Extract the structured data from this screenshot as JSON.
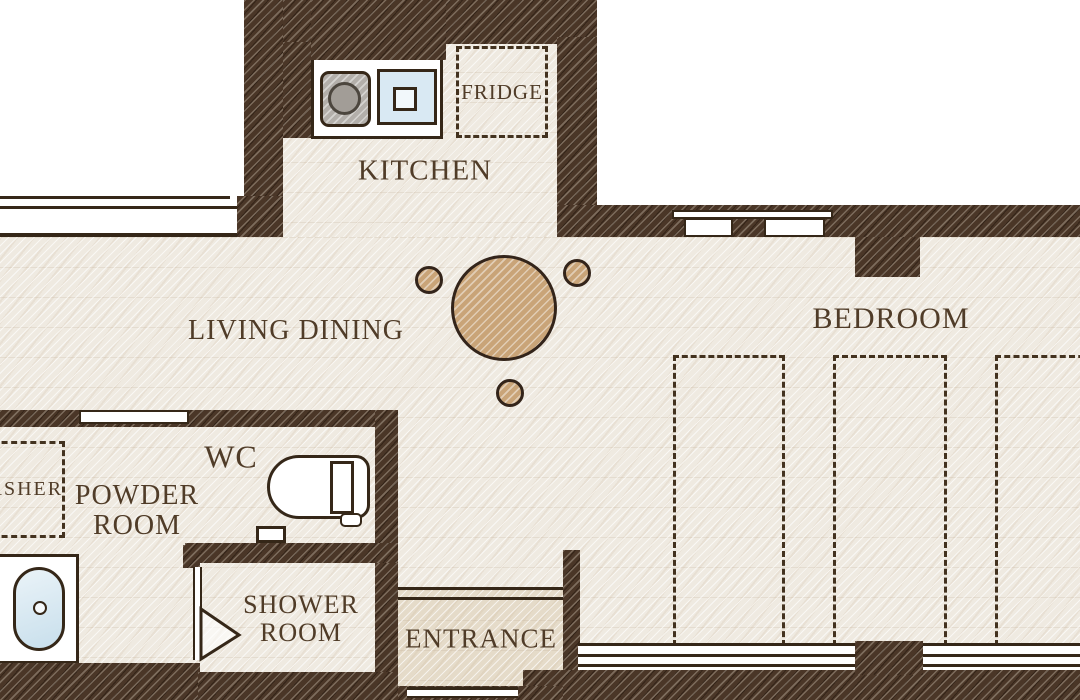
{
  "palette": {
    "wall": "#4a3627",
    "floor": "#efeae1",
    "genkan": "#e5dbc9",
    "line": "#352718",
    "text": "#503c28",
    "wood": "#c9a478",
    "water": "#d9e9f3",
    "metal": "#b3afaa"
  },
  "rooms": {
    "kitchen": {
      "label": "KITCHEN"
    },
    "living_dining": {
      "label": "LIVING DINING"
    },
    "bedroom": {
      "label": "BEDROOM"
    },
    "wc": {
      "label": "WC"
    },
    "powder_room": {
      "line1": "POWDER",
      "line2": "ROOM"
    },
    "shower_room": {
      "line1": "SHOWER",
      "line2": "ROOM"
    },
    "entrance": {
      "label": "ENTRANCE"
    }
  },
  "fixtures": {
    "fridge": {
      "label": "FRIDGE"
    },
    "washer": {
      "label": "WASHER"
    }
  }
}
